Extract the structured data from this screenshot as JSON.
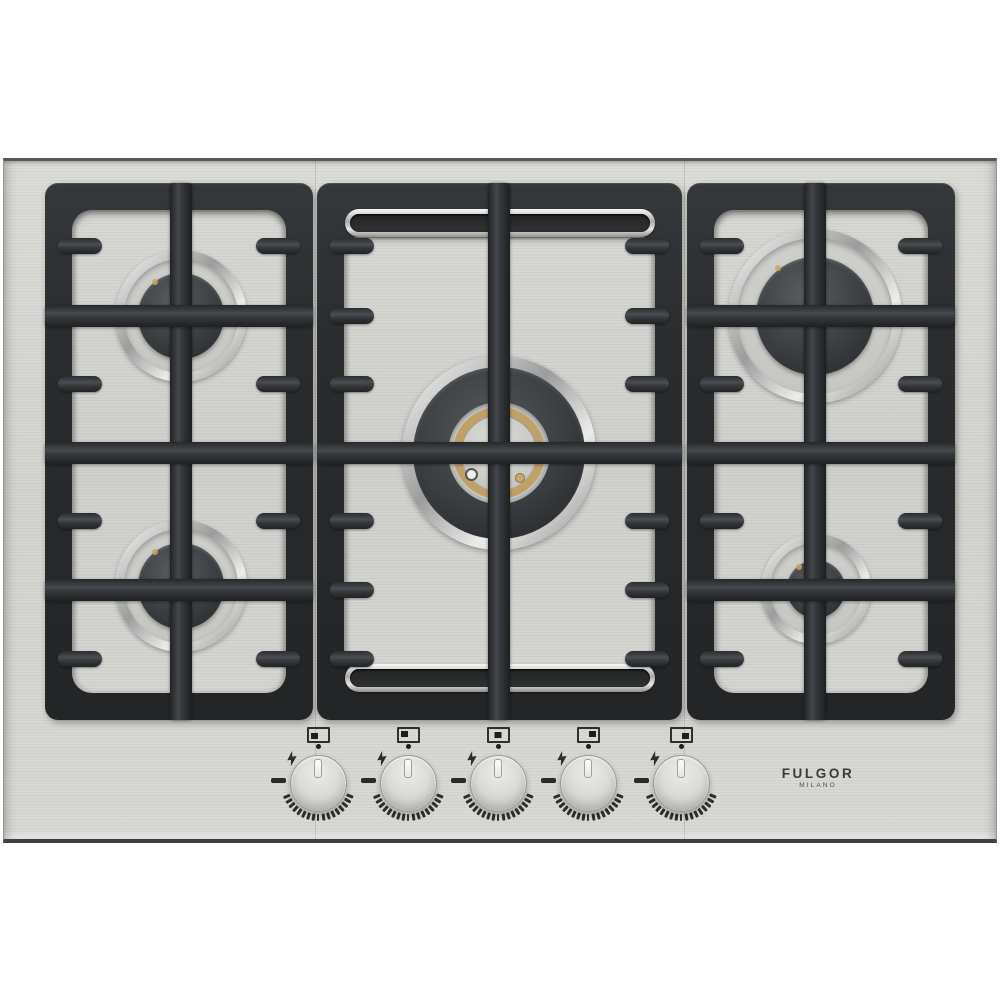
{
  "product": {
    "brand": "FULGOR",
    "brand_sub": "MILANO",
    "description": "5-burner stainless steel gas cooktop with cast-iron grates"
  },
  "burners": [
    {
      "id": "back-left",
      "size": "semi-rapid"
    },
    {
      "id": "front-left",
      "size": "semi-rapid"
    },
    {
      "id": "center",
      "size": "dual-ring wok"
    },
    {
      "id": "back-right",
      "size": "rapid"
    },
    {
      "id": "front-right",
      "size": "auxiliary"
    }
  ],
  "knobs": [
    {
      "id": "front-left",
      "icon_position": "bottom-left"
    },
    {
      "id": "back-left",
      "icon_position": "top-left"
    },
    {
      "id": "center",
      "icon_position": "center"
    },
    {
      "id": "back-right",
      "icon_position": "top-right"
    },
    {
      "id": "front-right",
      "icon_position": "bottom-right"
    }
  ],
  "icons": {
    "ignition-bolt-icon": "lightning bolt spark-ignition mark beside each knob",
    "burner-position-icon": "rectangle with filled dot marking which burner the knob controls",
    "knob-index-dot": "small round alignment dot above each knob",
    "max-flame-mark": "short dash at left of each dial",
    "flame-level-ticks": "arc of small tick marks around lower half of each dial"
  },
  "colors": {
    "steel": "#d5d5d2",
    "grate": "#2c2e30",
    "chrome": "#e9e9e7",
    "brass": "#c2a268",
    "burner_cap": "#3c3f42",
    "text": "#3a3a3a"
  }
}
